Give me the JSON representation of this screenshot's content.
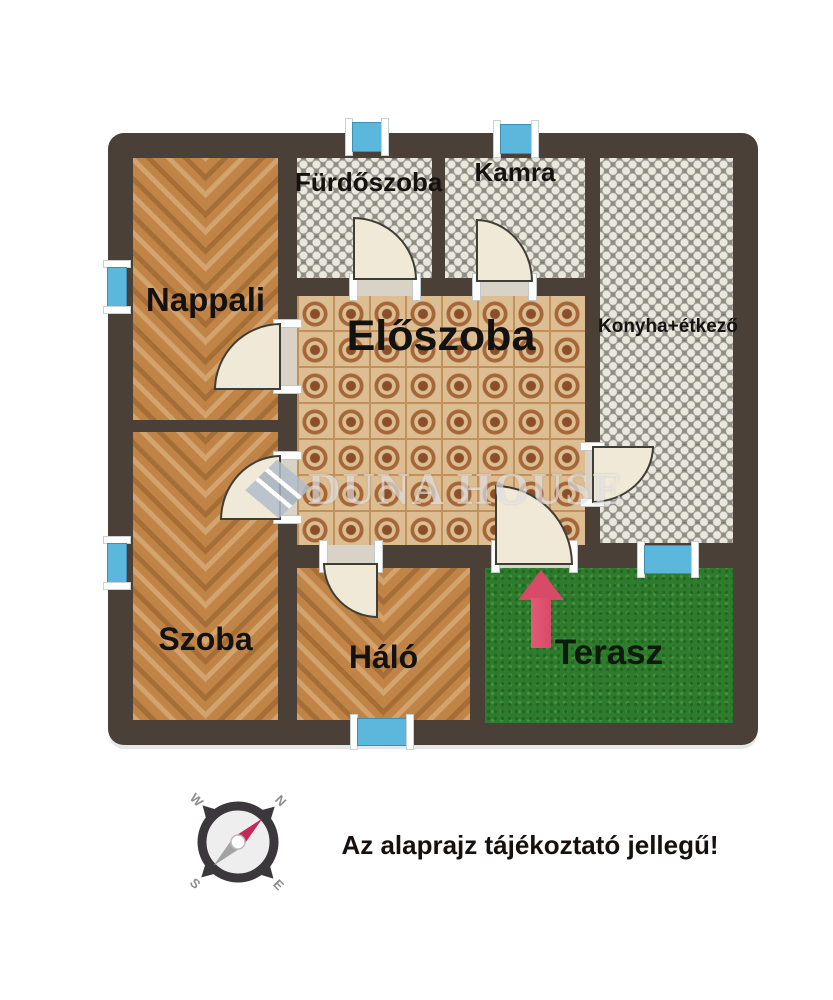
{
  "plan": {
    "rooms": [
      {
        "id": "nappali",
        "label": "Nappali",
        "floor": "wood"
      },
      {
        "id": "furdoszoba",
        "label": "Fürdőszoba",
        "floor": "tile-gray"
      },
      {
        "id": "kamra",
        "label": "Kamra",
        "floor": "tile-gray"
      },
      {
        "id": "eloszoba",
        "label": "Előszoba",
        "floor": "tile-tan"
      },
      {
        "id": "konyha",
        "label": "Konyha+étkező",
        "floor": "tile-gray"
      },
      {
        "id": "szoba",
        "label": "Szoba",
        "floor": "wood"
      },
      {
        "id": "halo",
        "label": "Háló",
        "floor": "wood"
      },
      {
        "id": "terasz",
        "label": "Terasz",
        "floor": "grass"
      }
    ],
    "watermark": {
      "text": "DUNA HOUSE"
    },
    "disclaimer": "Az alaprajz tájékoztató jellegű!",
    "compass": {
      "n": "N",
      "e": "E",
      "s": "S",
      "w": "W"
    },
    "counts": {
      "windows": 6,
      "doors": 7
    },
    "colors": {
      "wall": "#4a4037",
      "window_blue": "#5bb7dc",
      "door_fill": "#f0e9d7",
      "grass_green": "#2e7b2e",
      "wood_brown": "#c08447",
      "tile_gray": "#908d85",
      "tile_tan": "#ddbd92",
      "arrow_pink": "#d84a67",
      "compass_needle": "#c5295a"
    }
  }
}
